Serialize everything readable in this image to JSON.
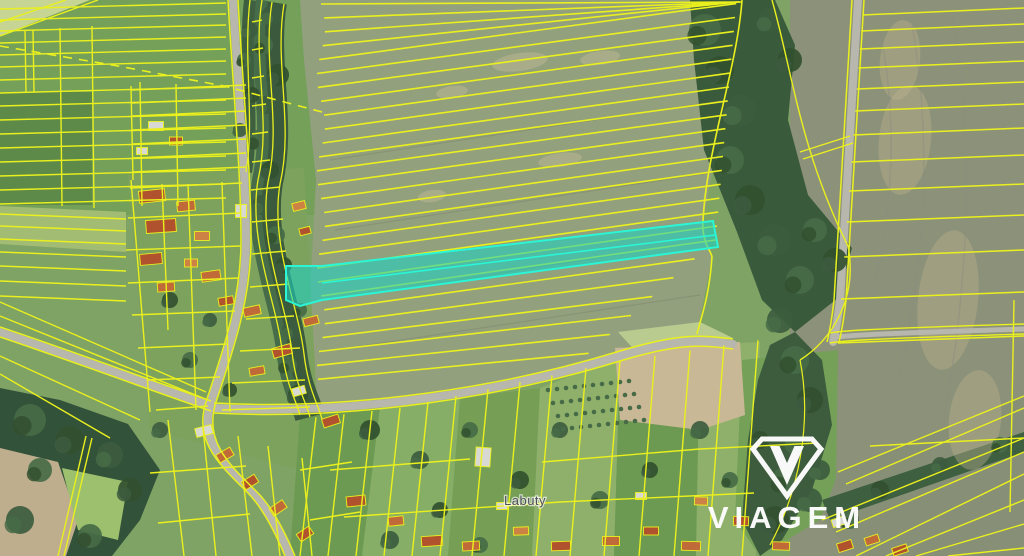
{
  "map": {
    "place_label": "Labuty",
    "watermark": "VIAGEM"
  },
  "icons": {
    "viagem_gem": "diamond-outline-with-v-icon"
  },
  "colors": {
    "parcel_line": "#eaf01e",
    "highlight_fill": "#1ad3c3",
    "highlight_fill_opacity": 0.58,
    "highlight_stroke": "#2af5d5",
    "field_center": "#93a07e",
    "field_left": "#74a05a",
    "field_left_dark": "#5d8a49",
    "field_left_light": "#a2bc74",
    "field_right": "#8c9279",
    "field_pale": "#c6d594",
    "meadow": "#9cc06e",
    "garden_a": "#6d9a52",
    "garden_b": "#86ae66",
    "garden_c": "#769f55",
    "garden_d": "#8fb06a",
    "forest": "#3a5a3c",
    "forest_dark": "#33523a",
    "tree_a": "#3d5c3f",
    "tree_b": "#466b46",
    "tree_c": "#32502f",
    "soil": "#bfae8e",
    "soil_patch": "#c9b896",
    "road": "#b7b7ae",
    "roof_1": "#b0522e",
    "roof_2": "#c06a3a",
    "roof_3": "#cd8245",
    "roof_4": "#d9d9d4",
    "label_color": "#50505a",
    "watermark_color": "#ffffff"
  }
}
